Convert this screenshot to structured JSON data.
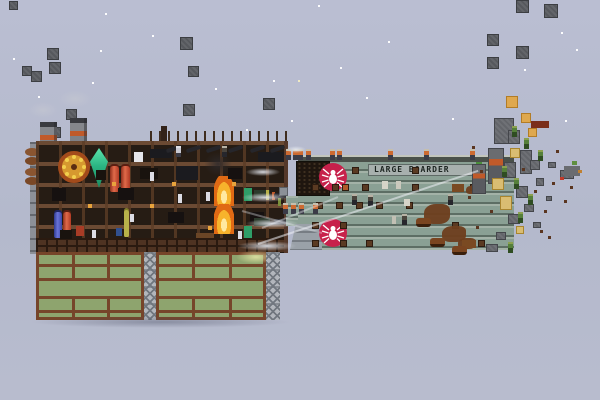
{
  "right_ship": {
    "name": "LARGE BOARDER",
    "emblem": "spider-on-red-roundel",
    "hatches": [
      [
        352,
        167
      ],
      [
        412,
        167
      ],
      [
        312,
        184
      ],
      [
        332,
        184
      ],
      [
        342,
        184,
        "#b05a2a"
      ],
      [
        362,
        184
      ],
      [
        412,
        184
      ],
      [
        470,
        184
      ],
      [
        316,
        202
      ],
      [
        336,
        202
      ],
      [
        356,
        202
      ],
      [
        376,
        202
      ],
      [
        406,
        202
      ],
      [
        312,
        222
      ],
      [
        340,
        222
      ],
      [
        452,
        222
      ],
      [
        312,
        240
      ],
      [
        340,
        240
      ],
      [
        366,
        240
      ],
      [
        478,
        240
      ]
    ],
    "lights": [
      [
        382,
        181,
        6,
        8,
        "#d6d4c8"
      ],
      [
        396,
        181,
        5,
        8,
        "#cbc9bd"
      ],
      [
        404,
        199,
        6,
        7,
        "#d6d4c8"
      ],
      [
        392,
        216,
        4,
        8,
        "#c2c0b4"
      ]
    ],
    "damage": [
      [
        424,
        204,
        26,
        20
      ],
      [
        442,
        226,
        24,
        16
      ],
      [
        458,
        238,
        18,
        11
      ],
      [
        466,
        186,
        10,
        8
      ]
    ],
    "items": [
      [
        452,
        184,
        12,
        8,
        "#7a4a22"
      ],
      [
        462,
        240,
        14,
        8,
        "#7a4a22"
      ],
      [
        476,
        162,
        6,
        8,
        "#4a8f3a"
      ]
    ],
    "crew": [
      [
        286,
        149
      ],
      [
        293,
        149
      ],
      [
        298,
        149
      ],
      [
        306,
        149
      ],
      [
        330,
        149
      ],
      [
        337,
        149
      ],
      [
        388,
        149
      ],
      [
        424,
        149
      ],
      [
        470,
        149
      ],
      [
        283,
        203
      ],
      [
        291,
        203
      ],
      [
        299,
        203
      ],
      [
        313,
        203
      ]
    ],
    "interior_crew": [
      [
        352,
        194
      ],
      [
        368,
        195
      ],
      [
        448,
        194
      ],
      [
        402,
        214
      ]
    ],
    "beasts": [
      [
        416,
        218
      ],
      [
        430,
        238
      ],
      [
        452,
        246
      ]
    ]
  },
  "left_ship": {
    "cannons": [
      [
        166,
        147
      ],
      [
        186,
        147
      ],
      [
        206,
        147
      ],
      [
        228,
        147
      ],
      [
        250,
        147
      ],
      [
        270,
        147
      ]
    ],
    "sideguns": [
      [
        274,
        193
      ],
      [
        274,
        219
      ]
    ],
    "crew": [
      [
        176,
        146,
        "pale"
      ],
      [
        222,
        146,
        "dark"
      ]
    ],
    "items": [
      [
        52,
        188,
        14,
        13,
        "#161110"
      ],
      [
        118,
        188,
        16,
        12,
        "#161110"
      ],
      [
        140,
        168,
        18,
        11,
        "#19130e"
      ],
      [
        168,
        212,
        16,
        11,
        "#161110"
      ],
      [
        60,
        230,
        12,
        9,
        "#19130e"
      ],
      [
        96,
        170,
        10,
        10,
        "#19130e"
      ],
      [
        228,
        168,
        14,
        11,
        "#161110"
      ],
      [
        250,
        212,
        14,
        10,
        "#161110"
      ],
      [
        150,
        149,
        22,
        9,
        "#1b1b1f"
      ],
      [
        176,
        166,
        22,
        14,
        "#1b1b1f"
      ],
      [
        258,
        152,
        26,
        10,
        "#1b1b1f"
      ],
      [
        134,
        152,
        9,
        10,
        "#e6e6ea"
      ],
      [
        150,
        172,
        4,
        9,
        "#dcdce4"
      ],
      [
        178,
        194,
        4,
        9,
        "#dcdce4"
      ],
      [
        92,
        230,
        4,
        8,
        "#dcdce4"
      ],
      [
        238,
        231,
        4,
        8,
        "#dcdce4"
      ],
      [
        130,
        214,
        4,
        8,
        "#dcdce4"
      ],
      [
        206,
        192,
        4,
        9,
        "#dcdce4"
      ],
      [
        112,
        182,
        4,
        4,
        "#e8a33c"
      ],
      [
        172,
        182,
        4,
        4,
        "#e8a33c"
      ],
      [
        232,
        182,
        4,
        4,
        "#e8a33c"
      ],
      [
        88,
        204,
        4,
        4,
        "#e8a33c"
      ],
      [
        208,
        226,
        4,
        4,
        "#e8a33c"
      ],
      [
        150,
        204,
        4,
        4,
        "#e8a33c"
      ],
      [
        244,
        188,
        8,
        13,
        "#2f9e68"
      ],
      [
        244,
        226,
        8,
        12,
        "#2f9e68"
      ],
      [
        254,
        190,
        16,
        8,
        "#2c3a2c"
      ],
      [
        254,
        218,
        16,
        8,
        "#2c3a2c"
      ],
      [
        266,
        190,
        3,
        10,
        "#b8b24a"
      ],
      [
        272,
        192,
        3,
        8,
        "#c05a2a"
      ],
      [
        278,
        198,
        3,
        8,
        "#7a8f3a"
      ],
      [
        76,
        226,
        8,
        10,
        "#a83c26"
      ],
      [
        116,
        228,
        6,
        8,
        "#31508f"
      ],
      [
        196,
        233,
        18,
        5,
        "#6a4526"
      ]
    ],
    "chambers": [
      [
        36,
        252,
        108,
        68
      ],
      [
        156,
        252,
        110,
        68
      ]
    ],
    "chamber_rows": [
      12,
      26,
      44,
      58
    ],
    "girders": [
      [
        144,
        252,
        12,
        68
      ],
      [
        266,
        252,
        14,
        68
      ]
    ]
  },
  "sky": {
    "stars": [
      [
        105,
        13
      ],
      [
        318,
        5
      ],
      [
        13,
        58
      ],
      [
        100,
        50
      ],
      [
        152,
        35
      ],
      [
        388,
        41
      ],
      [
        38,
        96
      ],
      [
        92,
        82
      ],
      [
        273,
        80
      ],
      [
        340,
        67
      ],
      [
        524,
        69
      ],
      [
        561,
        32
      ],
      [
        576,
        49
      ],
      [
        215,
        88
      ],
      [
        246,
        129
      ],
      [
        291,
        120
      ],
      [
        565,
        120
      ],
      [
        129,
        143
      ],
      [
        452,
        118
      ],
      [
        366,
        97
      ]
    ],
    "cream_stars": [
      [
        298,
        80
      ],
      [
        147,
        161
      ],
      [
        230,
        143
      ]
    ]
  },
  "debris": {
    "gray": [
      [
        9,
        1,
        9
      ],
      [
        47,
        48,
        12
      ],
      [
        22,
        66,
        10
      ],
      [
        31,
        71,
        11
      ],
      [
        49,
        62,
        12
      ],
      [
        66,
        109,
        11
      ],
      [
        72,
        119,
        12
      ],
      [
        50,
        127,
        11
      ],
      [
        180,
        37,
        13
      ],
      [
        188,
        66,
        11
      ],
      [
        183,
        104,
        12
      ],
      [
        263,
        98,
        12
      ],
      [
        516,
        0,
        13
      ],
      [
        544,
        4,
        14
      ],
      [
        487,
        34,
        12
      ],
      [
        516,
        46,
        13
      ],
      [
        487,
        57,
        12
      ]
    ],
    "orange": [
      [
        506,
        96,
        12
      ],
      [
        521,
        113,
        10
      ],
      [
        528,
        128,
        9
      ]
    ],
    "plank": [
      531,
      121,
      18,
      7,
      "#7a2e1a"
    ]
  },
  "wreck": {
    "blocks": [
      [
        488,
        148,
        16,
        36,
        1
      ],
      [
        472,
        164,
        14,
        30,
        1
      ],
      [
        494,
        118,
        20,
        26,
        0
      ],
      [
        508,
        130,
        12,
        14,
        0
      ],
      [
        520,
        150,
        12,
        24,
        0
      ],
      [
        504,
        162,
        12,
        16,
        0
      ],
      [
        530,
        160,
        10,
        10,
        0
      ],
      [
        516,
        186,
        12,
        12,
        0
      ],
      [
        536,
        178,
        8,
        8,
        0
      ],
      [
        548,
        162,
        8,
        6,
        0
      ],
      [
        524,
        204,
        10,
        8,
        0
      ],
      [
        508,
        214,
        12,
        10,
        0
      ],
      [
        533,
        222,
        8,
        6,
        0
      ],
      [
        546,
        196,
        6,
        5,
        0
      ],
      [
        560,
        170,
        14,
        9,
        0
      ],
      [
        496,
        232,
        10,
        8,
        0
      ],
      [
        486,
        244,
        12,
        8,
        0
      ]
    ],
    "tan": [
      [
        492,
        178,
        12,
        12
      ],
      [
        510,
        148,
        10,
        10
      ],
      [
        500,
        196,
        12,
        14
      ],
      [
        516,
        226,
        8,
        8
      ]
    ],
    "goblins": [
      [
        512,
        126
      ],
      [
        524,
        138
      ],
      [
        502,
        166
      ],
      [
        514,
        178
      ],
      [
        528,
        194
      ],
      [
        518,
        212
      ],
      [
        538,
        150
      ],
      [
        508,
        242
      ]
    ],
    "bits": [
      [
        472,
        146
      ],
      [
        480,
        170
      ],
      [
        468,
        196
      ],
      [
        476,
        226
      ],
      [
        490,
        210
      ],
      [
        522,
        168
      ],
      [
        534,
        190
      ],
      [
        544,
        210
      ],
      [
        552,
        182
      ],
      [
        540,
        230
      ],
      [
        556,
        150
      ],
      [
        564,
        200
      ],
      [
        548,
        236
      ],
      [
        570,
        186
      ]
    ],
    "extra": [
      [
        564,
        166,
        16,
        10,
        "#6a6c70"
      ],
      [
        560,
        177,
        4,
        3,
        "#c03a2a"
      ],
      [
        572,
        161,
        5,
        4,
        "#5f8f3f"
      ],
      [
        578,
        170,
        4,
        3,
        "#c08030"
      ]
    ]
  },
  "effects": {
    "trails": [
      [
        258,
        243,
        232,
        -18.4,
        0.55
      ],
      [
        262,
        227,
        82,
        -22.2,
        0.4
      ],
      [
        242,
        210,
        83,
        15.4,
        0.35
      ]
    ],
    "smoke": [
      [
        246,
        168,
        34,
        8
      ],
      [
        242,
        193,
        46,
        9
      ],
      [
        246,
        219,
        52,
        9
      ],
      [
        238,
        241,
        58,
        10
      ],
      [
        286,
        146,
        20,
        7
      ]
    ],
    "chimney_smoke": [
      [
        28,
        102,
        30,
        16
      ],
      [
        58,
        90,
        34,
        18
      ]
    ]
  },
  "colors": {
    "sky": "#b6bacd",
    "wood_hull": "#261c14",
    "deck_line": "#6b4a33",
    "chamber_green": "#8ea46e",
    "chamber_frame": "#76452a",
    "gray_hull": "#8aa094",
    "hull_seam": "#5d6e64",
    "emblem_red": "#c7214b",
    "crew_orange": "#cd6a31",
    "fire_orange": "#e06a14",
    "crystal_green": "#2bb583"
  }
}
